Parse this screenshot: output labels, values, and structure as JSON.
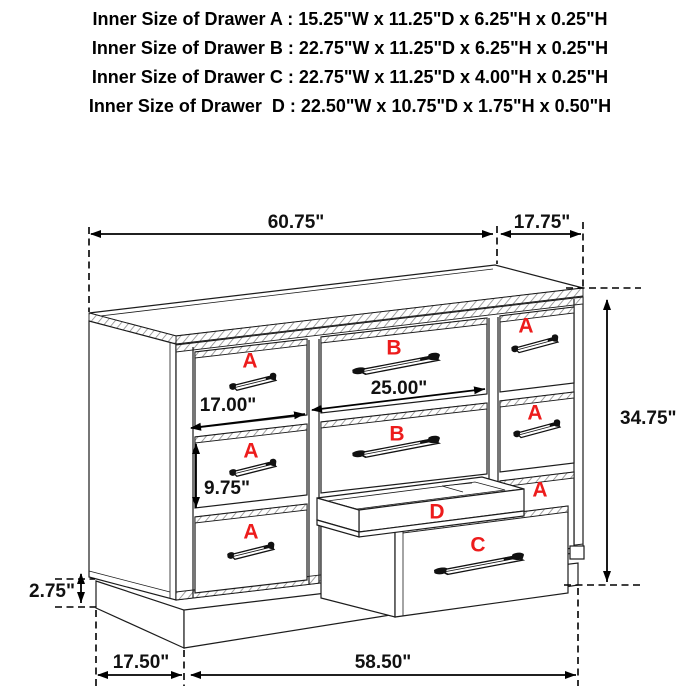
{
  "title_block": {
    "lines": [
      "Inner Size of Drawer A : 15.25\"W x 11.25\"D x 6.25\"H x 0.25\"H",
      "Inner Size of Drawer B : 22.75\"W x 11.25\"D x 6.25\"H x 0.25\"H",
      "Inner Size of Drawer C : 22.75\"W x 11.25\"D x 4.00\"H x 0.25\"H",
      "Inner Size of Drawer  D : 22.50\"W x 10.75\"D x 1.75\"H x 0.50\"H"
    ]
  },
  "dimensions": {
    "top_width": "60.75\"",
    "top_depth": "17.75\"",
    "overall_height": "34.75\"",
    "drawer_b_width": "25.00\"",
    "drawer_a_width": "17.00\"",
    "drawer_a_front_height": "9.75\"",
    "base_height": "2.75\"",
    "base_depth": "17.50\"",
    "base_width": "58.50\""
  },
  "drawer_labels": {
    "a": "A",
    "b": "B",
    "c": "C",
    "d": "D"
  },
  "colors": {
    "line": "#1c1c1c",
    "label_red": "#ed1c1c",
    "text": "#000000",
    "background": "#ffffff"
  }
}
